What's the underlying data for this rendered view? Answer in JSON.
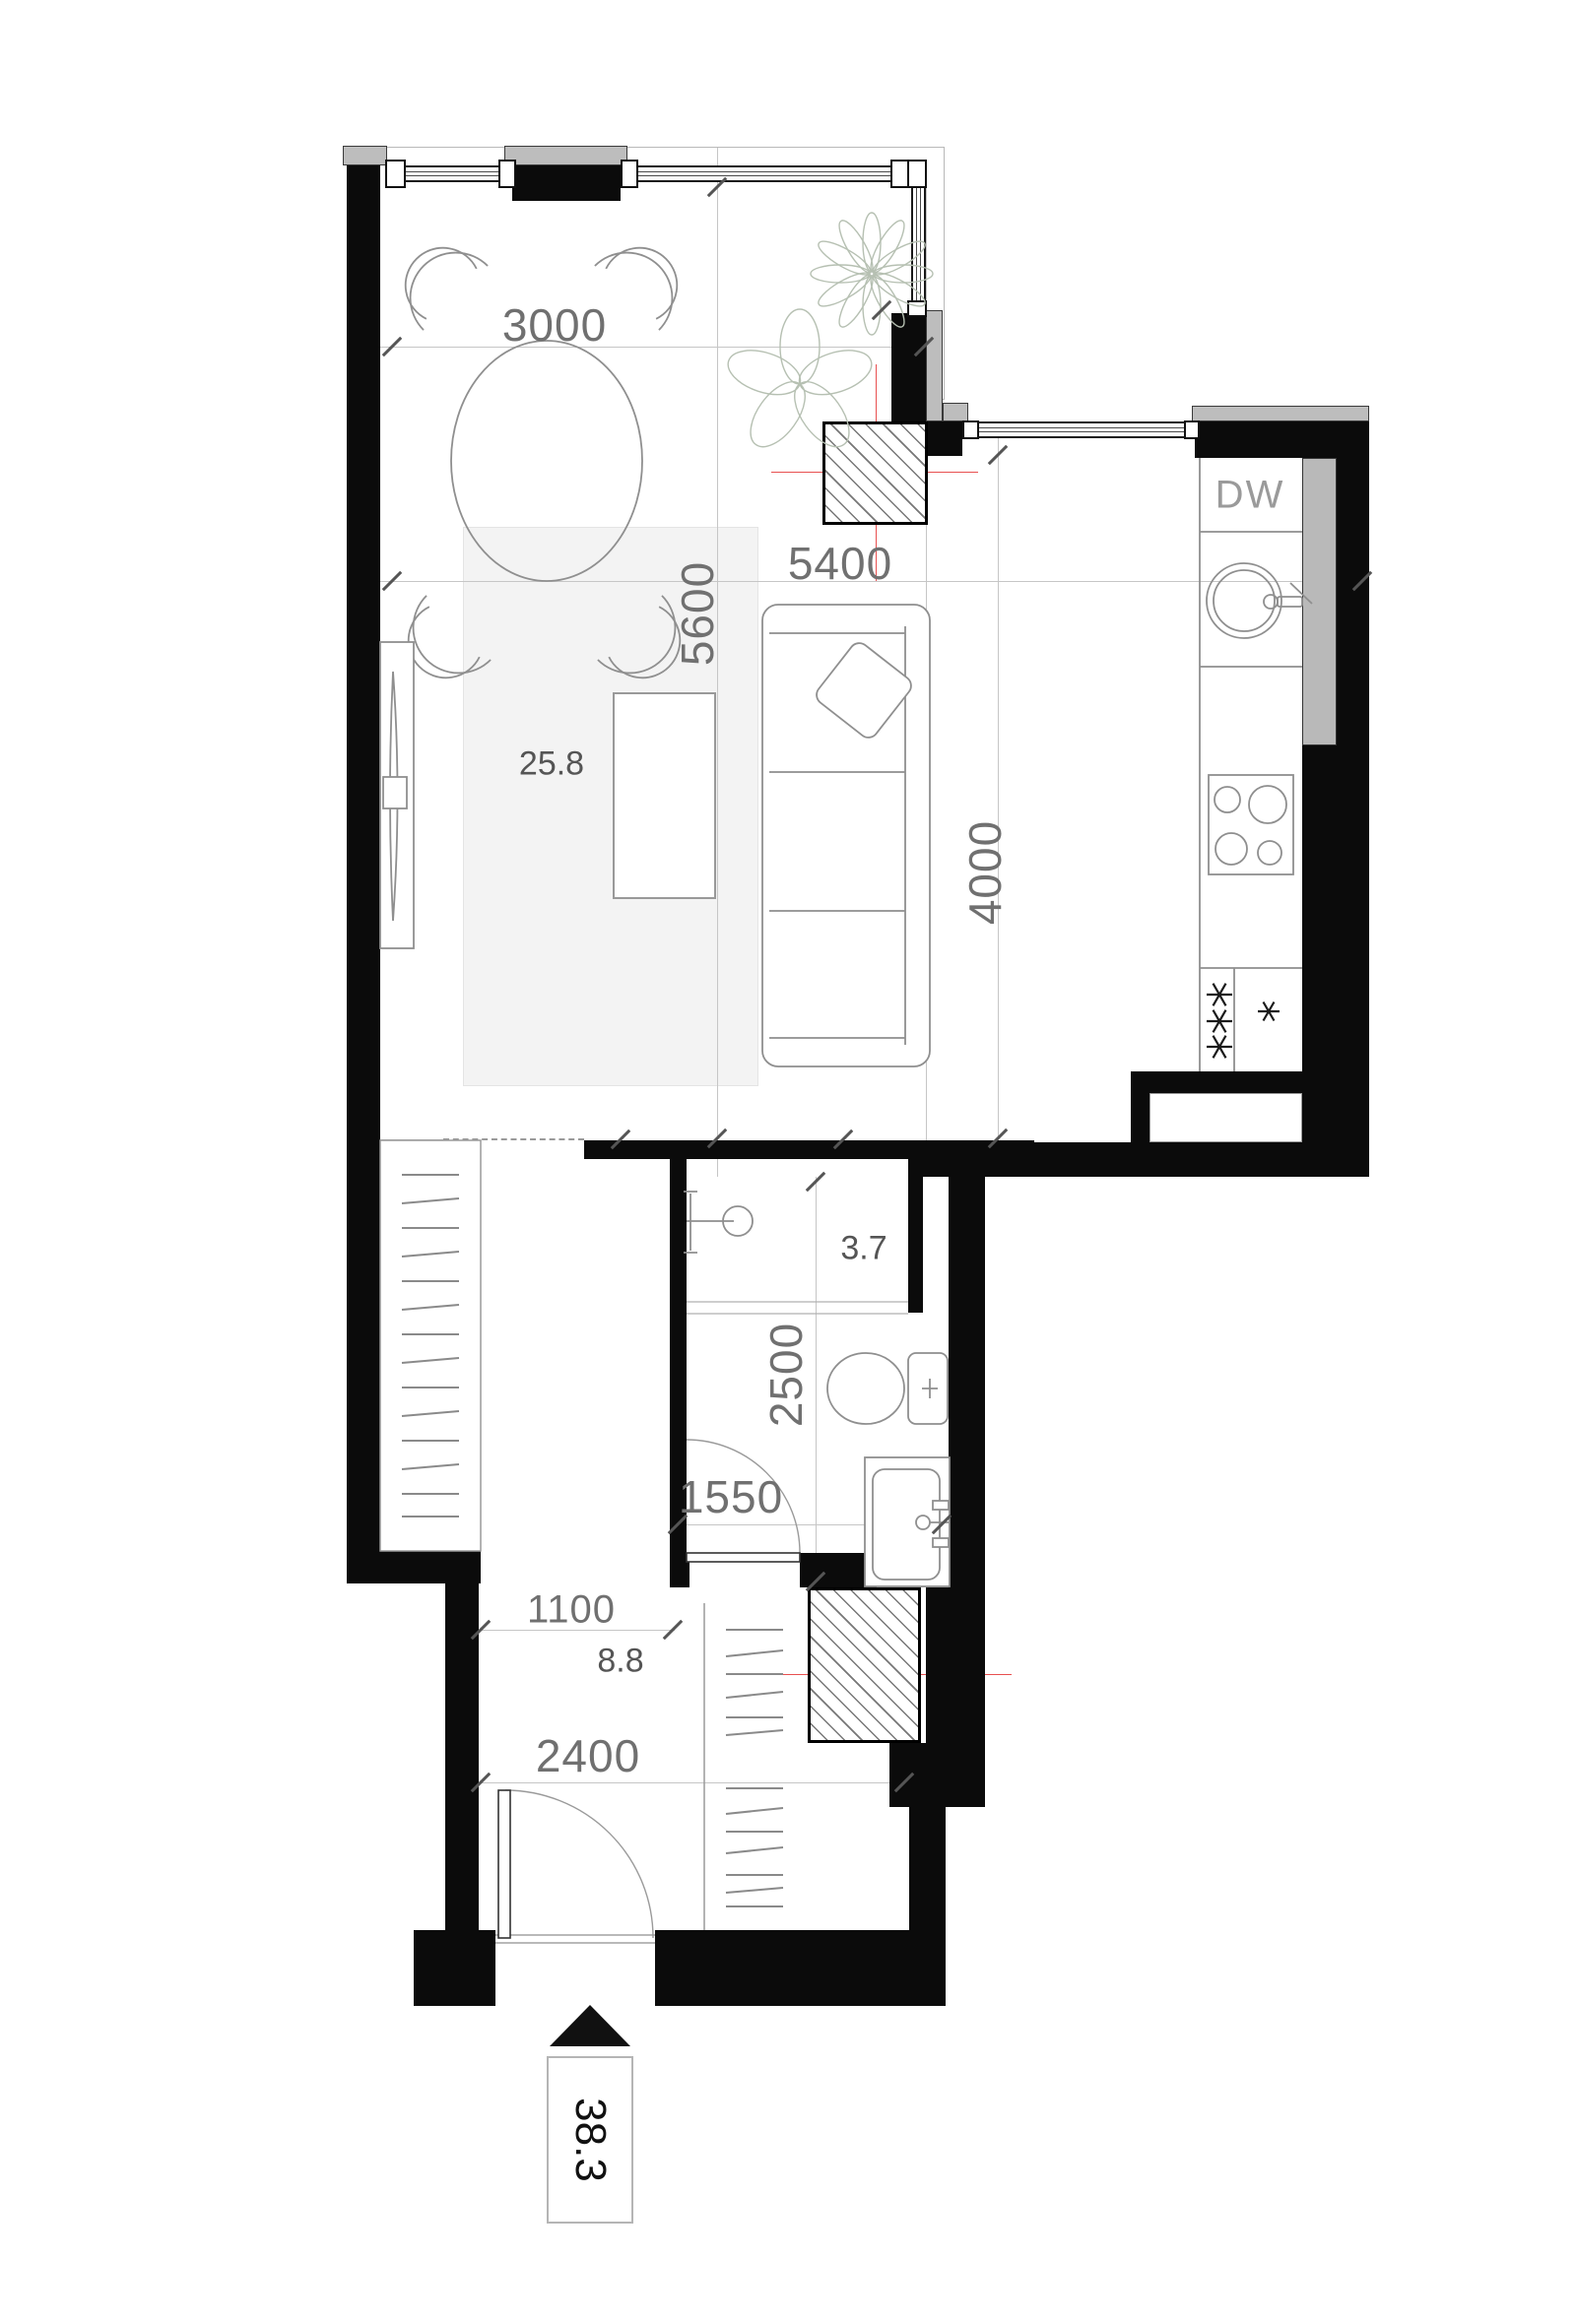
{
  "plan": {
    "type": "apartment-floor-plan",
    "areas": {
      "living_kitchen": "25.8",
      "bathroom": "3.7",
      "hallway": "8.8",
      "total": "38.3"
    },
    "dims": {
      "d3000": "3000",
      "d5400": "5400",
      "d5600": "5600",
      "d4000": "4000",
      "d2500": "2500",
      "d1550": "1550",
      "d1100": "1100",
      "d2400": "2400"
    },
    "labels": {
      "dishwasher": "DW"
    },
    "colors": {
      "wall": "#0b0b0b",
      "insulation": "#bdbdbd",
      "dim_text": "#707070",
      "area_text": "#555555",
      "axis_red": "#e85050",
      "grid": "#c6c6c6",
      "furniture": "#8f8f8f",
      "rug": "#f3f3f3",
      "plant": "#b6c0b2",
      "hatch": "#777777"
    }
  }
}
